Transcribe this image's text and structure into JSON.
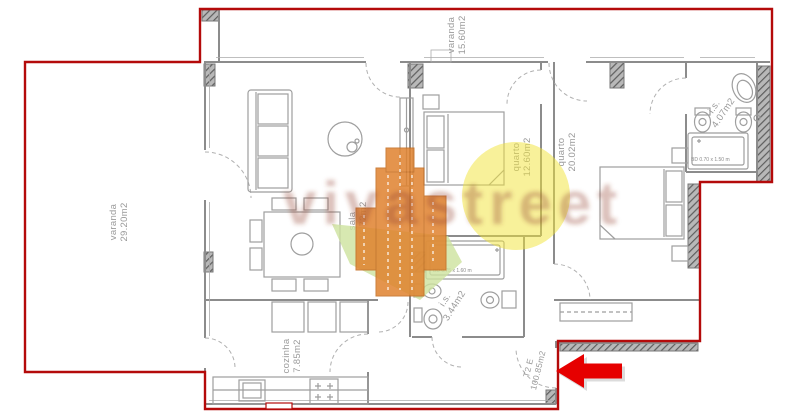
{
  "plan": {
    "type": "apartment floor plan",
    "watermark": {
      "text": "vivastreet"
    },
    "rooms": [
      {
        "name": "varanda",
        "area": "15.60m2"
      },
      {
        "name": "varanda",
        "area": "29.20m2"
      },
      {
        "name": "sala",
        "area": "26.72m2"
      },
      {
        "name": "quarto",
        "area": "12.60m2"
      },
      {
        "name": "quarto",
        "area": "20.02m2"
      },
      {
        "name": "i.s.",
        "area": "4.07m2"
      },
      {
        "name": "i.s.",
        "area": "3.44m2"
      },
      {
        "name": "cozinha",
        "area": "7.85m2"
      },
      {
        "name": "T2 E",
        "area": "100.85m2"
      }
    ],
    "fixtures": [
      {
        "label": "BD 0.70 x 1.50 m"
      },
      {
        "label": "BD 0.75 x 1.60 m"
      }
    ],
    "colors": {
      "outline": "#b40a0a",
      "walls": "#8c8c8c",
      "labels": "#9a9a9a",
      "arrow": "#e60000",
      "watermark_orange": "#e0822e",
      "watermark_yellow": "#f2e435",
      "watermark_green": "#cde29e"
    }
  }
}
